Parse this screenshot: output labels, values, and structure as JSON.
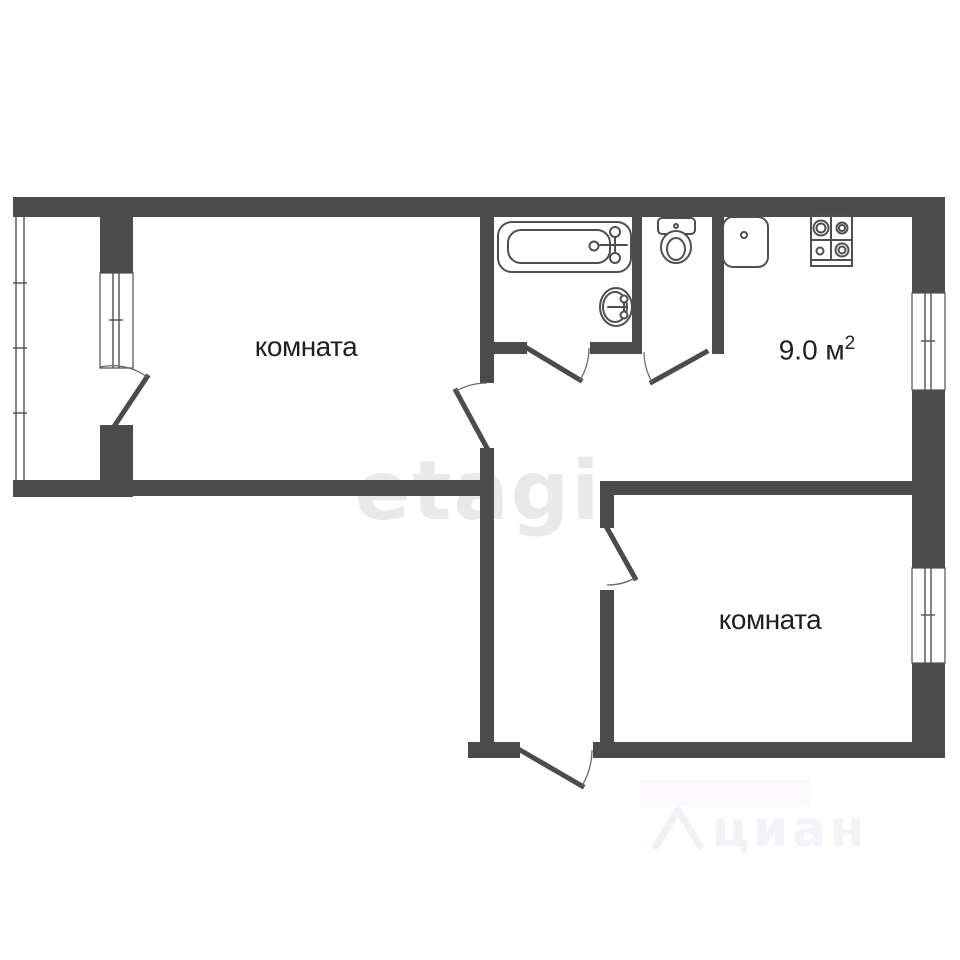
{
  "plan": {
    "type": "apartment-floor-plan",
    "rooms": [
      {
        "id": "left-room",
        "label": "комната"
      },
      {
        "id": "right-room",
        "label": "комната"
      },
      {
        "id": "kitchen",
        "area_label": "9.0 м",
        "area_sup": "2"
      }
    ],
    "fixtures": [
      "bathtub",
      "bathroom-sink",
      "toilet",
      "kitchen-sink",
      "stove"
    ]
  },
  "labels": {
    "left_room": "комната",
    "right_room": "комната",
    "kitchen_area": "9.0 м",
    "kitchen_area_sup": "2"
  },
  "watermarks": {
    "center": "etagi",
    "bottom_right": "циан"
  },
  "colors": {
    "wall": "#4b4b4b",
    "fixture": "#4f4f4f",
    "text": "#1f1f1f",
    "watermark_center": "#e9e9e9",
    "watermark_bottom": "#f4f1f8",
    "background": "#ffffff"
  }
}
